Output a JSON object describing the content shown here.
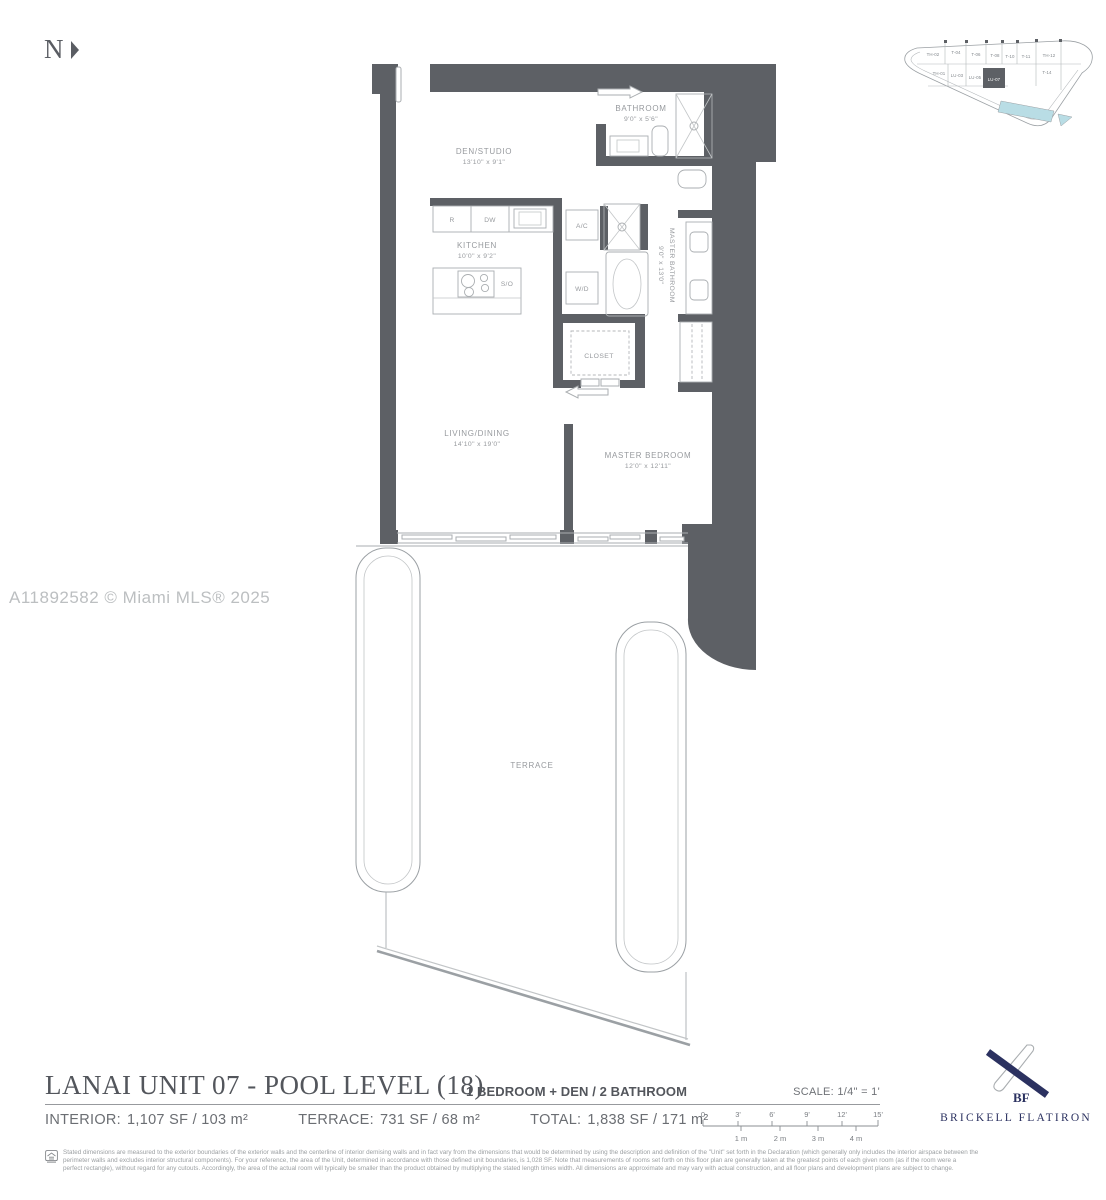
{
  "north_label": "N",
  "watermark": "A11892582 © Miami MLS® 2025",
  "rooms": {
    "bathroom": {
      "name": "BATHROOM",
      "dims": "9'0\" x 5'6\""
    },
    "den_studio": {
      "name": "DEN/STUDIO",
      "dims": "13'10\" x 9'1\""
    },
    "kitchen": {
      "name": "KITCHEN",
      "dims": "10'0\" x 9'2\""
    },
    "master_bathroom": {
      "name": "MASTER BATHROOM",
      "dims": "9'0\" x 13'0\""
    },
    "closet": {
      "name": "CLOSET"
    },
    "living_dining": {
      "name": "LIVING/DINING",
      "dims": "14'10\" x 19'0\""
    },
    "master_bedroom": {
      "name": "MASTER BEDROOM",
      "dims": "12'0\" x 12'11\""
    },
    "terrace": {
      "name": "TERRACE"
    }
  },
  "appliances": {
    "refrigerator": "R",
    "dishwasher": "DW",
    "stove_oven": "S/O",
    "ac": "A/C",
    "washer_dryer": "W/D"
  },
  "key_plan": {
    "highlighted": "LU-07",
    "units": [
      {
        "label": "TH-02"
      },
      {
        "label": "T-04"
      },
      {
        "label": "T-06"
      },
      {
        "label": "T-08"
      },
      {
        "label": "T-10"
      },
      {
        "label": "T-11"
      },
      {
        "label": "TH-12"
      },
      {
        "label": "TH-01"
      },
      {
        "label": "LU-03"
      },
      {
        "label": "LU-05"
      },
      {
        "label": "LU-07"
      },
      {
        "label": "T-14"
      }
    ]
  },
  "title_block": {
    "title": "LANAI UNIT 07 - POOL LEVEL (18)",
    "subtitle": "1 BEDROOM + DEN / 2 BATHROOM",
    "interior_label": "INTERIOR:",
    "interior_value": "1,107 SF / 103 m²",
    "terrace_label": "TERRACE:",
    "terrace_value": "731 SF / 68 m²",
    "total_label": "TOTAL:",
    "total_value": "1,838 SF / 171 m²",
    "scale_label": "SCALE: 1/4\" = 1'"
  },
  "scale_bar": {
    "feet": [
      "0",
      "3'",
      "6'",
      "9'",
      "12'",
      "15'"
    ],
    "meters": [
      "1 m",
      "2 m",
      "3 m",
      "4 m"
    ]
  },
  "brand": {
    "name": "BRICKELL FLATIRON",
    "monogram": "BF"
  },
  "disclaimer": {
    "line1": "Stated dimensions are measured to the exterior boundaries of the exterior walls and the centerline of interior demising walls and in fact vary from the dimensions that would be determined by using the description and definition of the \"Unit\" set forth in the Declaration (which generally only includes the interior airspace between the",
    "line2": "perimeter walls and excludes interior structural components).  For your reference, the area of the Unit, determined in accordance with those defined unit boundaries, is 1,028 SF.  Note that measurements of rooms set forth on this floor plan are generally taken at the greatest points of each given room (as if the room were a",
    "line3": "perfect rectangle), without regard for any cutouts.  Accordingly, the area of the actual room will typically be smaller than the product obtained by multiplying the stated length times width.  All dimensions are approximate and may vary with actual construction, and all floor plans and development plans are subject to change."
  }
}
